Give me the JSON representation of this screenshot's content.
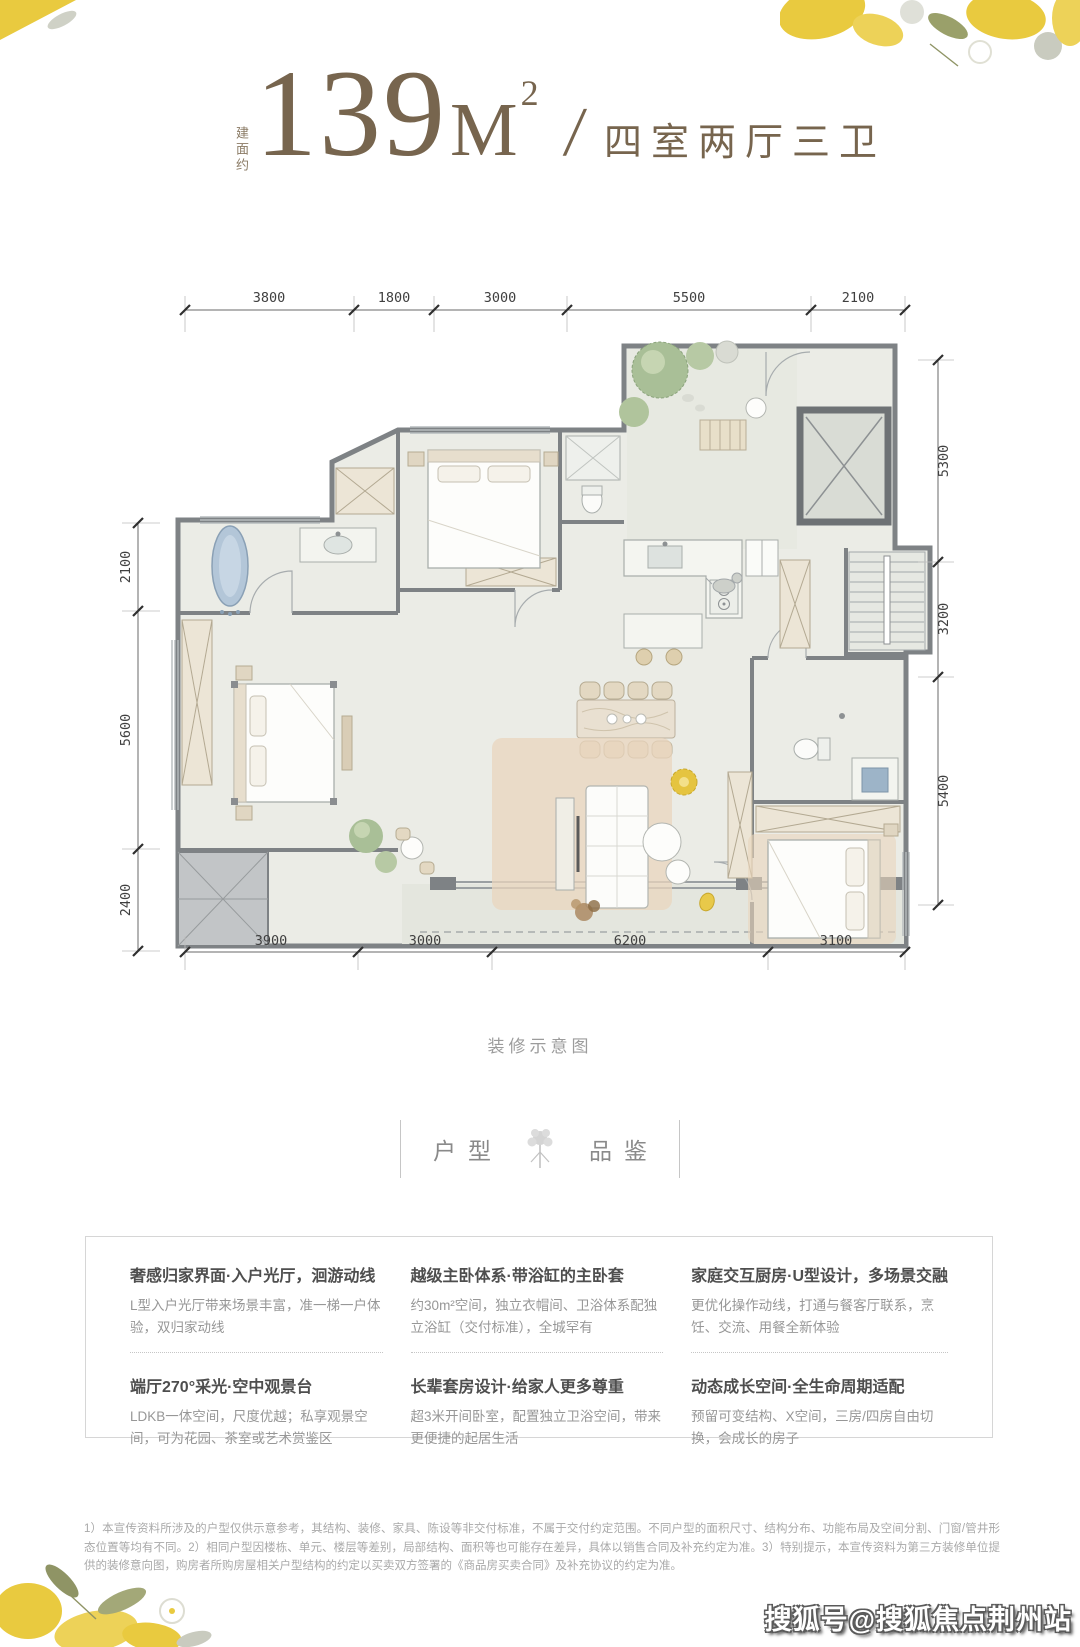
{
  "title": {
    "prefix_vertical": "建面约",
    "area_number": "139",
    "area_unit": "M",
    "area_exponent": "2",
    "divider": "/",
    "rooms_text": "四室两厅三卫"
  },
  "floorplan": {
    "caption": "装修示意图",
    "dim_top": [
      "3800",
      "1800",
      "3000",
      "5500",
      "2100"
    ],
    "dim_bottom": [
      "3900",
      "3000",
      "6200",
      "3100"
    ],
    "dim_left": [
      "2100",
      "5600",
      "2400"
    ],
    "dim_right": [
      "5300",
      "3200",
      "5400"
    ]
  },
  "section_header": {
    "word_left": "户型",
    "word_right": "品鉴"
  },
  "features": [
    {
      "title": "奢感归家界面·入户光厅，洄游动线",
      "body": "L型入户光厅带来场景丰富，准一梯一户体验，双归家动线"
    },
    {
      "title": "越级主卧体系·带浴缸的主卧套",
      "body": "约30m²空间，独立衣帽间、卫浴体系配独立浴缸（交付标准），全城罕有"
    },
    {
      "title": "家庭交互厨房·U型设计，多场景交融",
      "body": "更优化操作动线，打通与餐客厅联系，烹饪、交流、用餐全新体验"
    },
    {
      "title": "端厅270°采光·空中观景台",
      "body": "LDKB一体空间，尺度优越；私享观景空间，可为花园、茶室或艺术赏鉴区"
    },
    {
      "title": "长辈套房设计·给家人更多尊重",
      "body": "超3米开间卧室，配置独立卫浴空间，带来更便捷的起居生活"
    },
    {
      "title": "动态成长空间·全生命周期适配",
      "body": "预留可变结构、X空间，三房/四房自由切换，会成长的房子"
    }
  ],
  "disclaimer": {
    "text": "1）本宣传资料所涉及的户型仅供示意参考，其结构、装修、家具、陈设等非交付标准，不属于交付约定范围。不同户型的面积尺寸、结构分布、功能布局及空间分割、门窗/管井形态位置等均有不同。2）相同户型因楼栋、单元、楼层等差别，局部结构、面积等也可能存在差异，具体以销售合同及补充约定为准。3）特别提示，本宣传资料为第三方装修单位提供的装修意向图，购房者所购房屋相关户型结构的约定以买卖双方签署的《商品房买卖合同》及补充协议的约定为准。"
  },
  "watermark": {
    "text": "搜狐号@搜狐焦点荆州站"
  },
  "colors": {
    "accent_brown": "#77654e",
    "accent_yellow": "#e9ca3f",
    "wall_gray": "#7e8285",
    "floor": "#ebece6"
  }
}
